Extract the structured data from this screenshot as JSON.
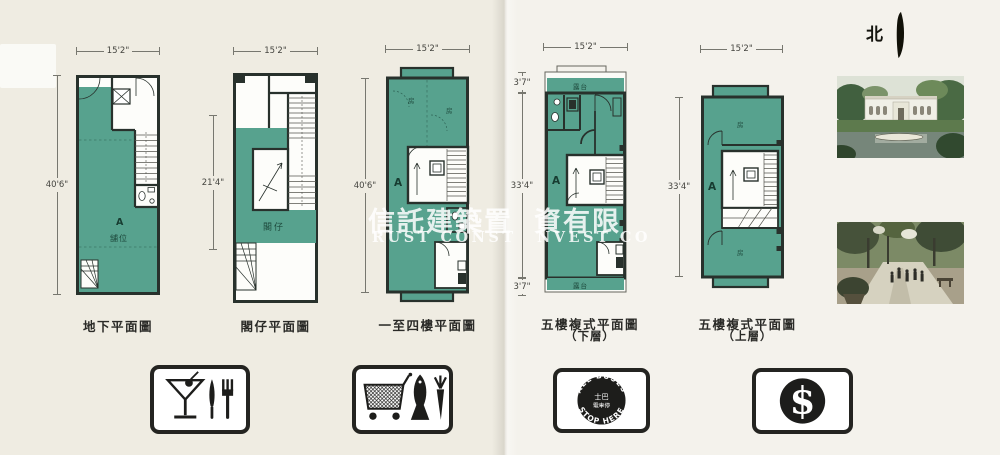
{
  "north_label": "北",
  "watermark": {
    "zh_left": "信託建築置",
    "zh_right": "資有限",
    "en_left": "RUST CONST",
    "en_right": "NVEST CO"
  },
  "plans": [
    {
      "caption": "地下平面圖",
      "dim_top": "15'2\"",
      "dim_left": "40'6\"",
      "unit": "A",
      "room": "舖位"
    },
    {
      "caption": "閣仔平面圖",
      "dim_top": "15'2\"",
      "dim_left": "21'4\"",
      "room": "閣仔"
    },
    {
      "caption": "一至四樓平面圖",
      "dim_top": "15'2\"",
      "dim_left": "40'6\"",
      "unit": "A",
      "room_top": "房",
      "room_right": "房"
    },
    {
      "caption": "五樓複式平面圖",
      "caption_sub": "（下層）",
      "dim_top": "15'2\"",
      "dim_left_top": "3'7\"",
      "dim_left_mid": "33'4\"",
      "dim_left_bottom": "3'7\"",
      "unit": "A",
      "balcony_top": "露台",
      "balcony_bottom": "露台"
    },
    {
      "caption": "五樓複式平面圖",
      "caption_sub": "（上層）",
      "dim_top": "15'2\"",
      "dim_left_mid": "33'4\"",
      "unit": "A",
      "room_top": "房",
      "room_bottom": "房"
    }
  ],
  "amenities": {
    "bus": {
      "arc_top": "ALL BUSES",
      "arc_bottom": "STOP HERE",
      "center_line1": "士巴",
      "center_line2": "電車停"
    },
    "money": {
      "symbol": "$"
    }
  },
  "colors": {
    "teal": "#57a28e",
    "wall": "#28312c",
    "page_left": "#efece2",
    "page_right": "#f4f2ec",
    "icon_black": "#1d1d1b"
  }
}
